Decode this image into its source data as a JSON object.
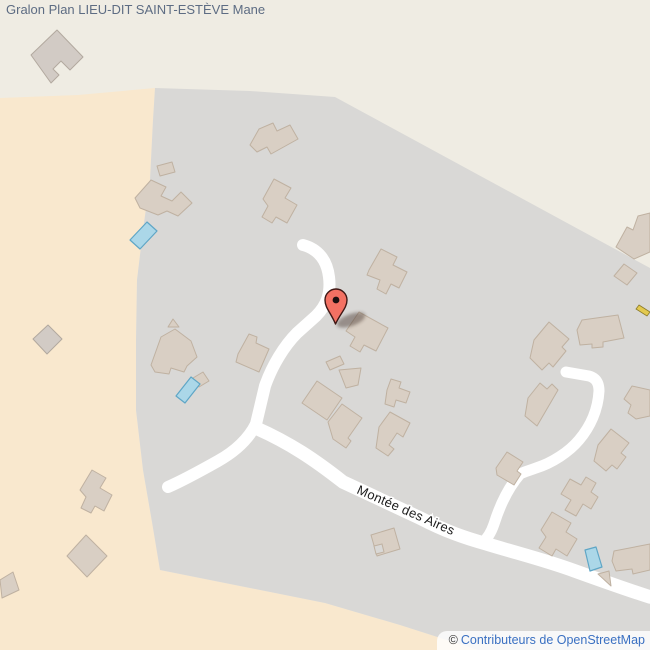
{
  "page": {
    "title": "Gralon Plan LIEU-DIT SAINT-ESTÈVE Mane"
  },
  "map": {
    "street_label": "Montée des Aires",
    "attribution": {
      "copyright_symbol": "©",
      "link_text": "Contributeurs de OpenStreetMap"
    },
    "colors": {
      "background_land": "#efece3",
      "farmland": "#f9e8ce",
      "residential": "#d9d8d6",
      "building_fill": "#d9cfc4",
      "building_stroke": "#bfb1a1",
      "road": "#ffffff",
      "swimming_pool": "#abd7e8",
      "marker": "#f37163",
      "yellow_path": "#e3c94f",
      "title_text": "#5d6c83",
      "attribution_link": "#3a70c2"
    }
  }
}
